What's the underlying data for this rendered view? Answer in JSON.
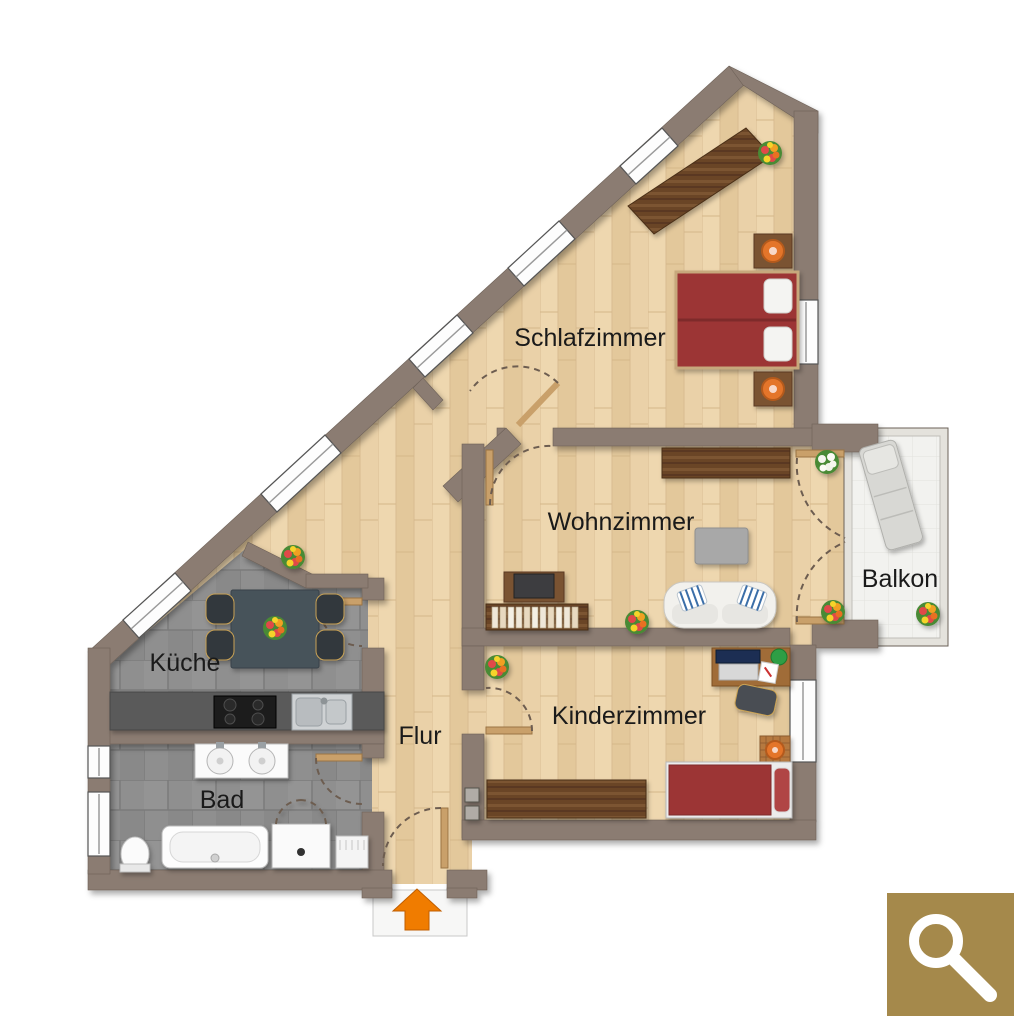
{
  "rooms": {
    "schlafzimmer": {
      "label": "Schlafzimmer"
    },
    "wohnzimmer": {
      "label": "Wohnzimmer"
    },
    "balkon": {
      "label": "Balkon"
    },
    "kueche": {
      "label": "Küche"
    },
    "flur": {
      "label": "Flur"
    },
    "bad": {
      "label": "Bad"
    },
    "kinderzimmer": {
      "label": "Kinderzimmer"
    }
  },
  "icons": {
    "magnifier": "magnifier-icon",
    "entrance_arrow": "entrance-arrow-icon"
  },
  "colors": {
    "wall": "#8b7b72",
    "wood_floor": "#e9d0a7",
    "tile_floor": "#8f8f8f",
    "balcony_floor": "#f2f2ef",
    "bed_red": "#9c3434",
    "furniture_wood": "#6a4526",
    "entrance_orange": "#f07c00",
    "zoom_button_gold": "#a5894b",
    "label_text": "#1a1a1a"
  }
}
